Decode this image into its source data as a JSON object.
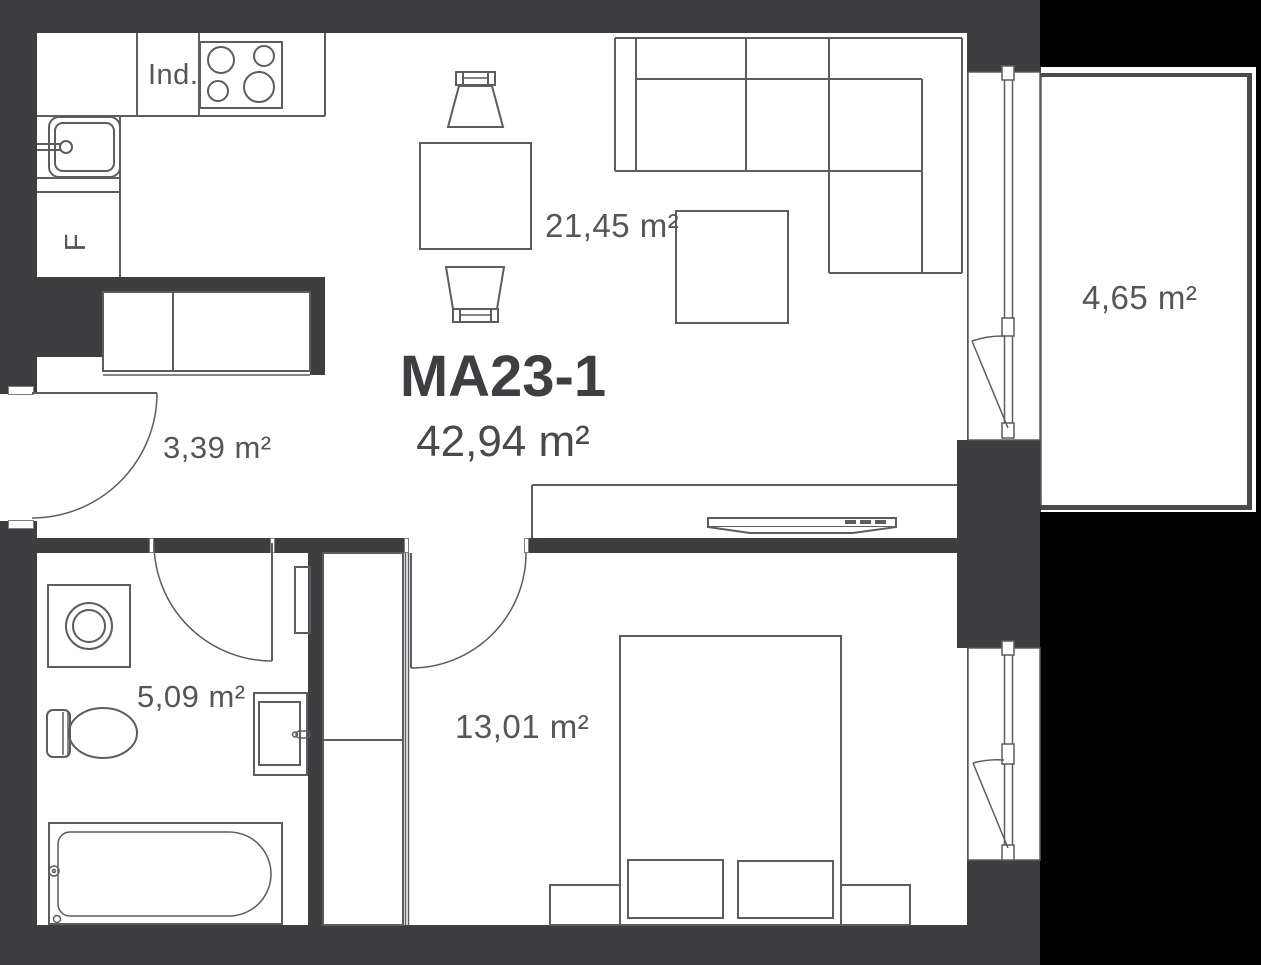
{
  "plan": {
    "unit_name": "MA23-1",
    "total_area": "42,94 m²"
  },
  "rooms": {
    "living_kitchen": {
      "area": "21,45 m²"
    },
    "hall": {
      "area": "3,39 m²"
    },
    "bathroom": {
      "area": "5,09 m²"
    },
    "bedroom": {
      "area": "13,01 m²"
    },
    "balcony": {
      "area": "4,65 m²"
    }
  },
  "appliances": {
    "induction_hob": "Ind.",
    "fridge": "F"
  },
  "colors": {
    "wall": "#3e3e41",
    "floor": "#ffffff",
    "outside": "#000000",
    "outline": "#5c5c61",
    "label_text": "#56565a",
    "title_text": "#3f3f43"
  }
}
